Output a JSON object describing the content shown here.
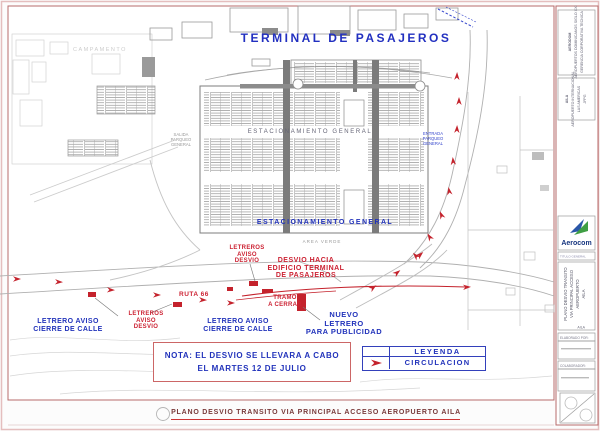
{
  "colors": {
    "annotation_red": "#cc2233",
    "annotation_blue": "#2233bb",
    "frame_red": "#b76b6b",
    "title_blue": "#2230c0",
    "bottom_title_maroon": "#7a3b3b"
  },
  "map": {
    "terminal_title": "TERMINAL DE PASAJEROS",
    "parking_label_top": "ESTACIONAMIENTO GENERAL",
    "parking_label_bottom": "ESTACIONAMIENTO GENERAL",
    "area_verde": "AREA VERDE",
    "campamento": "CAMPAMENTO",
    "entrada_parqueo_lines": [
      "ENTRADA",
      "PARQUEO",
      "GENERAL"
    ],
    "salida_parqueo_lines": [
      "SALIDA",
      "PARQUEO",
      "GENERAL"
    ],
    "annotations": {
      "letreros_aviso_desvio_center": "LETREROS\nAVISO\nDESVIO",
      "letreros_aviso_desvio_left": "LETREROS\nAVISO\nDESVIO",
      "desvio_hacia": "DESVIO HACIA\nEDIFICIO TERMINAL\nDE PASAJEROS",
      "ruta66": "RUTA 66",
      "tramo_a_cerrar": "TRAMO\nA CERRAR",
      "letrero_cierre_center": "LETRERO AVISO\nCIERRE DE CALLE",
      "letrero_cierre_left": "LETRERO AVISO\nCIERRE DE CALLE",
      "nuevo_letrero": "NUEVO\nLETRERO\nPARA PUBLICIDAD"
    }
  },
  "note_box": {
    "line1": "NOTA: EL DESVIO SE LLEVARA A CABO",
    "line2": "EL MARTES 12 DE JULIO"
  },
  "legend": {
    "title": "LEYENDA",
    "items": [
      {
        "icon": "red-arrow",
        "label": "CIRCULACION"
      }
    ]
  },
  "title_bar": {
    "text": "PLANO DESVIO TRANSITO VIA PRINCIPAL ACCESO AEROPUERTO AILA"
  },
  "sidebar": {
    "block1_lines": [
      "AERODOM",
      "AEROPUERTOS DOMINICANOS SIGLO XXI",
      "GERENCIA CORPORATIVA TECNICA"
    ],
    "block2_lines": [
      "AILA",
      "AEROPUERTO INTERNACIONAL",
      "LAS AMERICAS",
      "JFPG"
    ],
    "logo": {
      "brand": "Aerocom"
    },
    "band_label": "TITULO GENERAL",
    "drawing_title_lines": [
      "PLANO DESVIO TRANSITO",
      "VIA PRINCIPAL ACCESO",
      "AEROPUERTO",
      "AILA"
    ],
    "drawing_title_code": "AILA",
    "fields": [
      {
        "label": "ELABORADO POR:"
      },
      {
        "label": "COLABORADOR:"
      }
    ]
  }
}
